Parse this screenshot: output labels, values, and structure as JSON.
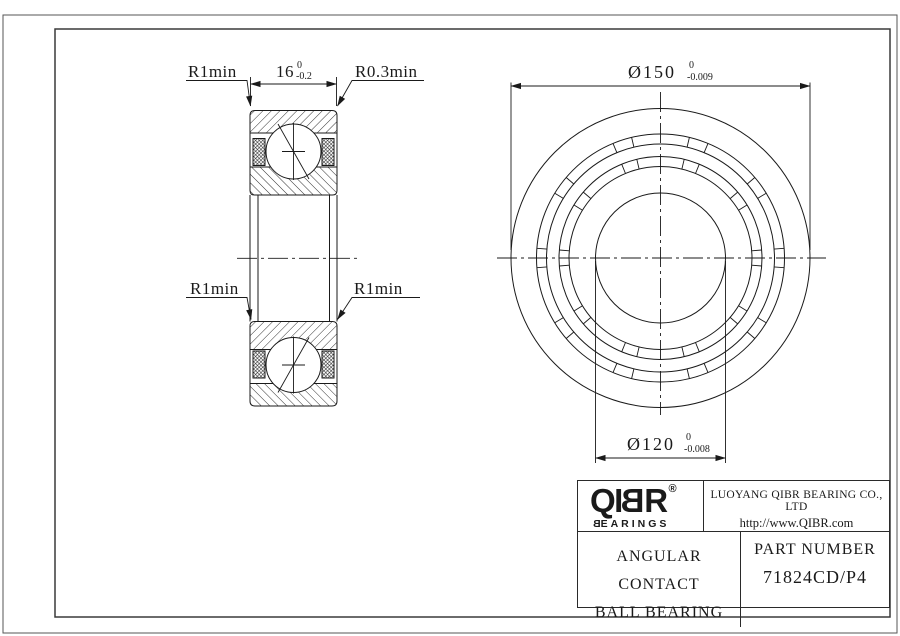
{
  "colors": {
    "background": "#ffffff",
    "ink": "#1a1a1a"
  },
  "section_view": {
    "label_r1min_top": "R1min",
    "label_r03min": "R0.3min",
    "label_r1min_left": "R1min",
    "label_r1min_right": "R1min",
    "dim_width": {
      "value": "16",
      "tol_upper": "0",
      "tol_lower": "-0.2"
    }
  },
  "front_view": {
    "dim_outer": {
      "value": "Ø150",
      "tol_upper": "0",
      "tol_lower": "-0.009"
    },
    "dim_bore": {
      "value": "Ø120",
      "tol_upper": "0",
      "tol_lower": "-0.008"
    }
  },
  "title_block": {
    "logo": {
      "part1": "QI",
      "reversed": "B",
      "part2": "R",
      "registered": "®",
      "sub_reversed": "B",
      "sub_rest": "EARINGS"
    },
    "company": "LUOYANG QIBR BEARING CO., LTD",
    "website": "http://www.QIBR.com",
    "product_type_line1": "ANGULAR CONTACT",
    "product_type_line2": "BALL BEARING",
    "part_number_label": "PART NUMBER",
    "part_number": "71824CD/P4"
  }
}
